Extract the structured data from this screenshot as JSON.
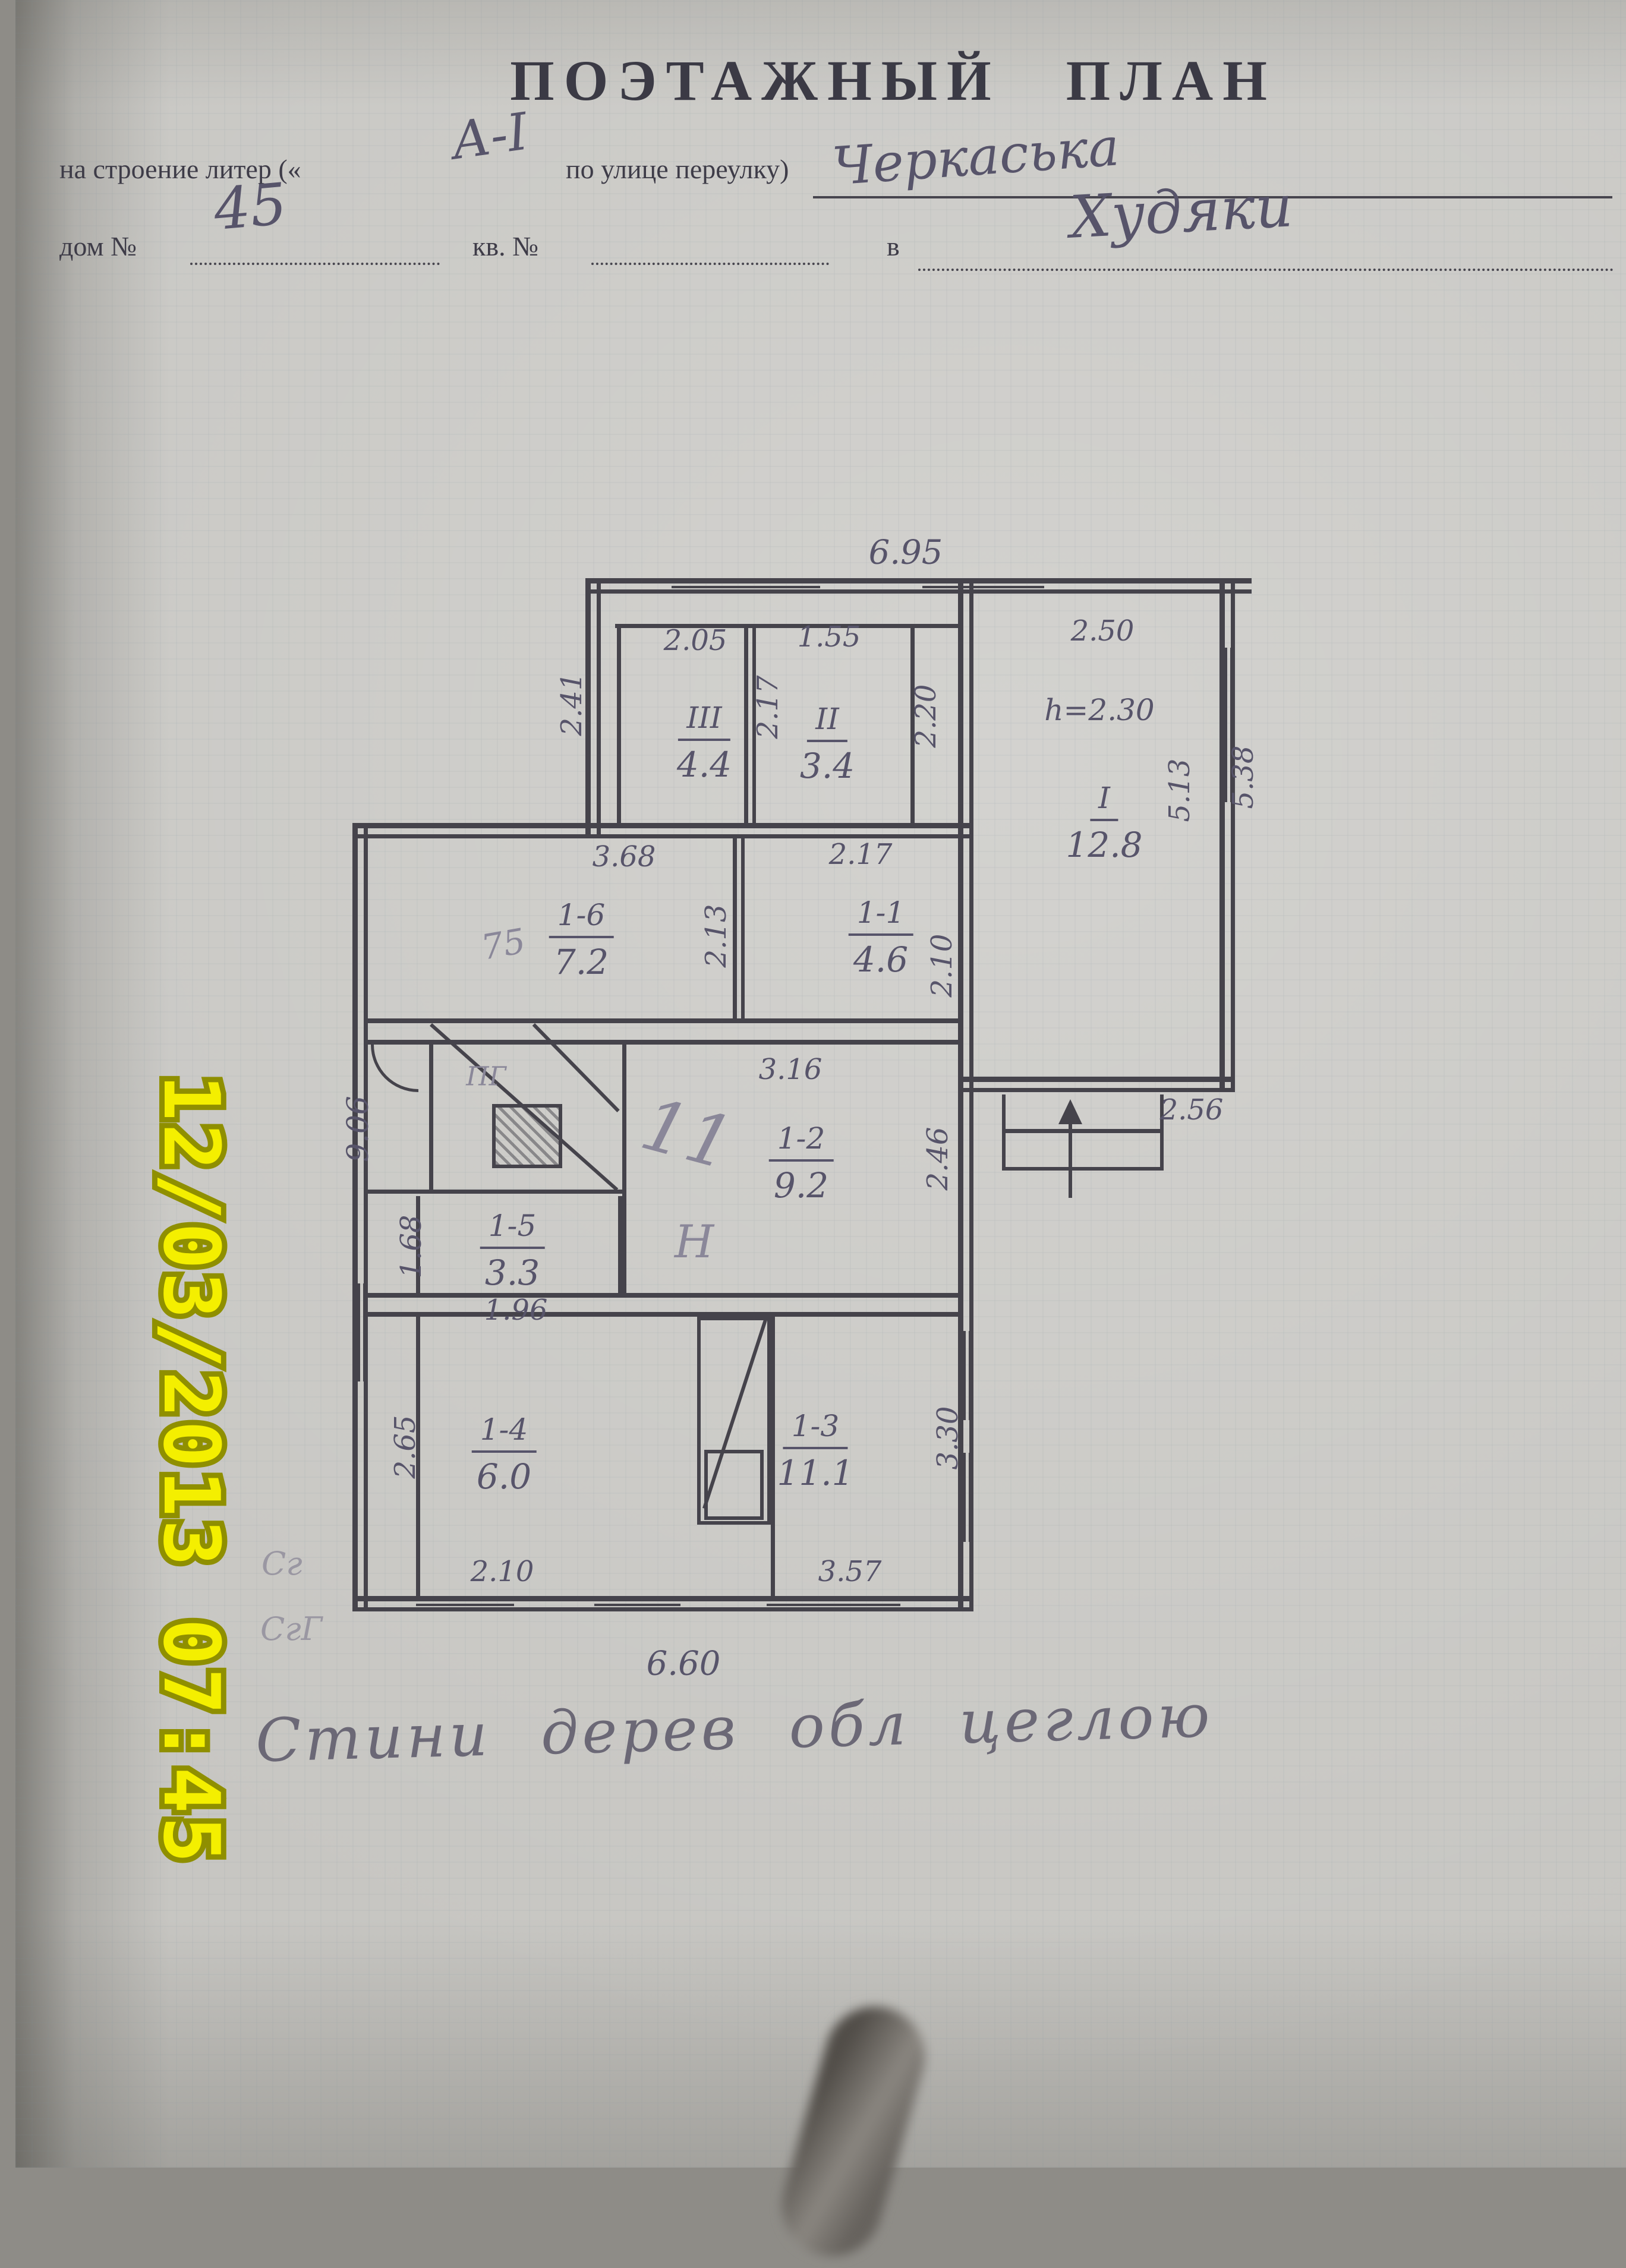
{
  "photo": {
    "timestamp": "12/03/2013 07:45"
  },
  "header": {
    "title": "ПОЭТАЖНЫЙ  ПЛАН",
    "line1": {
      "prefix": "на строение литер («",
      "litera": "А-I",
      "suffix": "по улице переулку)",
      "value": "Черкаська"
    },
    "line2": {
      "dom": "дом №",
      "dom_value": "45",
      "kv": "кв. №",
      "v": "в",
      "value": "Худяки"
    }
  },
  "plan": {
    "dims": {
      "top": "6.95",
      "bottom": "6.60",
      "left": "9.06",
      "room3_w": "2.05",
      "room3_h": "2.41",
      "room3_side": "2.17",
      "room2_w": "1.55",
      "room2_side": "2.20",
      "room1_w": "2.50",
      "room1_height_note": "h=2.30",
      "room1_side_in": "5.13",
      "room1_side_out": "5.38",
      "porch": "2.56",
      "r16_w": "3.68",
      "r16_side": "2.13",
      "r11_w": "2.17",
      "r11_side": "2.10",
      "r12_w": "3.16",
      "r12_side": "2.46",
      "r15_w": "1.96",
      "r15_side": "1.68",
      "r14_w": "2.10",
      "r14_side": "2.65",
      "r13_w": "3.57",
      "r13_side": "3.30"
    },
    "rooms": {
      "r3": {
        "id": "III",
        "area": "4.4"
      },
      "r2": {
        "id": "II",
        "area": "3.4"
      },
      "r1": {
        "id": "I",
        "area": "12.8"
      },
      "r16": {
        "id": "1-6",
        "area": "7.2"
      },
      "r11": {
        "id": "1-1",
        "area": "4.6"
      },
      "r12": {
        "id": "1-2",
        "area": "9.2"
      },
      "r15": {
        "id": "1-5",
        "area": "3.3"
      },
      "r14": {
        "id": "1-4",
        "area": "6.0"
      },
      "r13": {
        "id": "1-3",
        "area": "11.1"
      }
    },
    "annotations": {
      "stove": "ПГ",
      "hand_11": "11",
      "hand_n": "Н",
      "scribble": "75",
      "mark1": "Сг",
      "mark2": "СгГ",
      "note": "Стини дерев обл цеглою"
    }
  }
}
